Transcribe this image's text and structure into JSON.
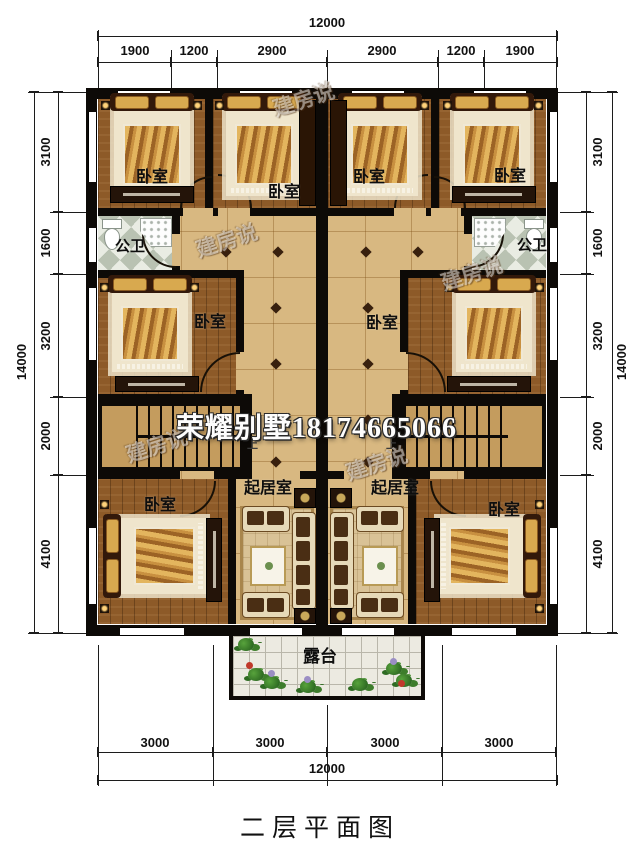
{
  "title": "二层平面图",
  "watermarks": {
    "brand": "荣耀别墅18174665066",
    "stamp": "建房说"
  },
  "room_labels": {
    "bedroom": "卧室",
    "bathroom": "公卫",
    "living_room": "起居室",
    "terrace": "露台",
    "stairs_up": "上"
  },
  "dimensions": {
    "top": {
      "total": "12000",
      "segments": [
        "1900",
        "1200",
        "2900",
        "2900",
        "1200",
        "1900"
      ]
    },
    "bottom": {
      "total": "12000",
      "segments": [
        "3000",
        "3000",
        "3000",
        "3000"
      ]
    },
    "left": {
      "total": "14000",
      "segments": [
        "3100",
        "1600",
        "3200",
        "2000",
        "4100"
      ]
    },
    "right": {
      "total": "14000",
      "segments": [
        "3100",
        "1600",
        "3200",
        "2000",
        "4100"
      ]
    }
  },
  "colors": {
    "wall": "#0d0a07",
    "wood_floor": "#8d5a28",
    "corridor_tile": "#d8b881",
    "terrace_tile": "#eceae1",
    "blanket_gold": "#d9a84f",
    "accent_diamond": "#38200e"
  }
}
